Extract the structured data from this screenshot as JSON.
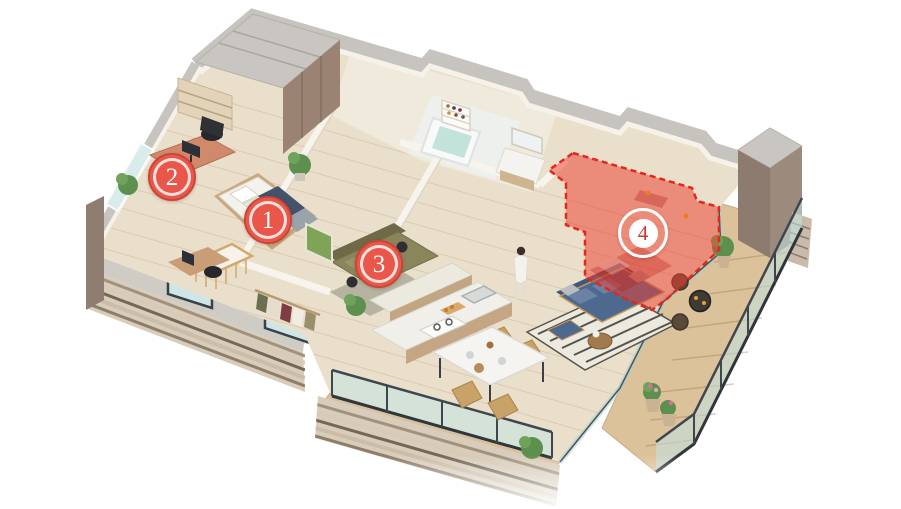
{
  "floorplan": {
    "description": "Isometric cutaway floor plan of an apartment with four numbered room markers; room 4 is highlighted with a red dashed selection overlay.",
    "markers": [
      {
        "label": "1",
        "variant": "filled"
      },
      {
        "label": "2",
        "variant": "filled"
      },
      {
        "label": "3",
        "variant": "filled"
      },
      {
        "label": "4",
        "variant": "outlined-active"
      }
    ],
    "highlight": {
      "marker": "4",
      "fill": "rgba(236,62,47,0.52)",
      "border": "#e32718",
      "border_style": "dashed"
    },
    "colors": {
      "marker_fill": "#e8574a",
      "marker_border": "#cf4335",
      "marker_ring": "#ffffff",
      "active_number": "#d2372b",
      "background": "#ffffff"
    }
  }
}
